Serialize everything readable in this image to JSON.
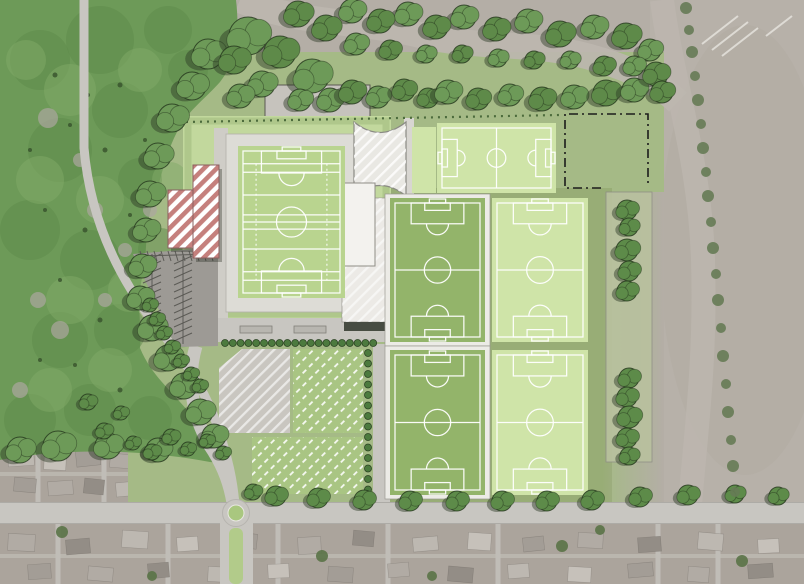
{
  "meta": {
    "description": "Aerial masterplan rendering of a sports grounds: a main hybrid stadium pitch with embankment, five training soccer pitches, a hatched entrance plaza, clubhouse pavilion, proposed red-hatched buildings, herringbone car park, allotment-style hatched plots, tree belts, woodland to the west, farmland to the east and housing along the southern road with a roundabout.",
    "visible_text": []
  },
  "palette": {
    "aerial": "#b4aea6",
    "farm": "#b7b1a9",
    "farmTrack": "#bdb7af",
    "road": "#c8c6c1",
    "parking": "#9d9a95",
    "woodland": "#6d9a58",
    "woodDark": "#5e8a49",
    "woodLight": "#81aa67",
    "treeGreen": "#5d8b49",
    "shadow": "#3c4a33",
    "siteGrass": "#a5ba86",
    "sage": "#8ea269",
    "platform": "#c2d89d",
    "embank": "#aac387",
    "frameFill": "#dddcd6",
    "stadiumPitch": "#b9d48f",
    "pitchLight": "#cfe4a8",
    "pitchDark": "#93b46a",
    "line": "#ffffff",
    "plotGreen": "#a9c583",
    "plotGrey": "#c9c6c0",
    "white": "#f3f2ee",
    "red": "#c5807d",
    "shrub": "#4c7a3e",
    "housingBase": "#aba49c",
    "median": "#b2cb8a",
    "roundGreen": "#a9c77f",
    "boundary": "#1c1c1c",
    "stripPanel": "#b9c19f",
    "farmTree": "#667b55",
    "houseShades": [
      "#bdb8b1",
      "#c6c1ba",
      "#a39d96",
      "#b1aba4",
      "#938d86"
    ]
  },
  "scene": {
    "pitches": [
      {
        "id": "stadium-pitch",
        "label": "Main stadium pitch (hybrid GAA/soccer markings)",
        "x": 238,
        "y": 146,
        "w": 107,
        "h": 152,
        "fill": "stadiumPitch",
        "orient": "v",
        "hybrid": true
      },
      {
        "id": "pitch-north",
        "label": "Training pitch north (horizontal)",
        "x": 437,
        "y": 123,
        "w": 119,
        "h": 70,
        "fill": "pitchLight",
        "orient": "h"
      },
      {
        "id": "pitch-mid-west",
        "label": "Training pitch centre-west",
        "x": 390,
        "y": 198,
        "w": 95,
        "h": 144,
        "fill": "pitchDark",
        "orient": "v",
        "frame": true
      },
      {
        "id": "pitch-mid-east",
        "label": "Training pitch centre-east",
        "x": 492,
        "y": 198,
        "w": 96,
        "h": 144,
        "fill": "pitchLight",
        "orient": "v"
      },
      {
        "id": "pitch-south-west",
        "label": "Training pitch south-west",
        "x": 390,
        "y": 350,
        "w": 95,
        "h": 145,
        "fill": "pitchDark",
        "orient": "v",
        "frame": true
      },
      {
        "id": "pitch-south-east",
        "label": "Training pitch south-east",
        "x": 492,
        "y": 350,
        "w": 96,
        "h": 145,
        "fill": "pitchLight",
        "orient": "v"
      }
    ],
    "trees": {
      "canopy": [
        [
          248,
          36,
          19
        ],
        [
          280,
          52,
          16
        ],
        [
          312,
          76,
          17
        ],
        [
          298,
          14,
          13
        ],
        [
          262,
          84,
          13
        ],
        [
          234,
          60,
          14
        ],
        [
          330,
          100,
          12
        ],
        [
          352,
          92,
          12
        ],
        [
          378,
          97,
          11
        ],
        [
          404,
          90,
          11
        ],
        [
          300,
          100,
          11
        ],
        [
          428,
          98,
          10
        ],
        [
          448,
          92,
          12
        ],
        [
          478,
          99,
          11
        ],
        [
          510,
          95,
          11
        ],
        [
          542,
          99,
          12
        ],
        [
          574,
          97,
          12
        ],
        [
          606,
          93,
          13
        ],
        [
          634,
          90,
          12
        ],
        [
          656,
          74,
          12
        ],
        [
          650,
          50,
          11
        ],
        [
          626,
          36,
          13
        ],
        [
          594,
          27,
          12
        ],
        [
          560,
          34,
          13
        ],
        [
          528,
          21,
          12
        ],
        [
          496,
          29,
          12
        ],
        [
          464,
          17,
          12
        ],
        [
          436,
          27,
          12
        ],
        [
          408,
          14,
          12
        ],
        [
          380,
          21,
          12
        ],
        [
          352,
          11,
          12
        ],
        [
          326,
          28,
          13
        ],
        [
          356,
          44,
          11
        ],
        [
          390,
          50,
          10
        ],
        [
          426,
          54,
          9
        ],
        [
          462,
          54,
          9
        ],
        [
          498,
          58,
          9
        ],
        [
          534,
          60,
          9
        ],
        [
          570,
          60,
          9
        ],
        [
          604,
          66,
          10
        ],
        [
          634,
          66,
          10
        ],
        [
          662,
          92,
          11
        ],
        [
          240,
          96,
          12
        ]
      ],
      "edge": [
        [
          208,
          54,
          15
        ],
        [
          192,
          86,
          14
        ],
        [
          172,
          118,
          14
        ],
        [
          158,
          156,
          13
        ],
        [
          150,
          194,
          13
        ],
        [
          146,
          230,
          12
        ],
        [
          142,
          266,
          12
        ],
        [
          140,
          298,
          12
        ],
        [
          152,
          328,
          13
        ],
        [
          168,
          358,
          13
        ],
        [
          184,
          386,
          13
        ],
        [
          200,
          412,
          13
        ],
        [
          214,
          436,
          12
        ],
        [
          58,
          446,
          15
        ],
        [
          108,
          446,
          13
        ],
        [
          158,
          450,
          12
        ],
        [
          20,
          450,
          13
        ]
      ],
      "scatter": [
        [
          88,
          402,
          8
        ],
        [
          104,
          431,
          8
        ],
        [
          121,
          413,
          7
        ],
        [
          133,
          443,
          7
        ],
        [
          152,
          452,
          8
        ],
        [
          171,
          437,
          8
        ],
        [
          188,
          449,
          7
        ],
        [
          207,
          441,
          7
        ],
        [
          223,
          453,
          7
        ],
        [
          150,
          305,
          7
        ],
        [
          157,
          319,
          7
        ],
        [
          164,
          333,
          7
        ],
        [
          172,
          347,
          7
        ],
        [
          181,
          361,
          7
        ],
        [
          191,
          374,
          7
        ],
        [
          200,
          386,
          7
        ],
        [
          253,
          492,
          8
        ],
        [
          276,
          496,
          10
        ]
      ],
      "strip": [
        [
          627,
          210,
          10
        ],
        [
          629,
          227,
          9
        ],
        [
          627,
          250,
          11
        ],
        [
          629,
          271,
          10
        ],
        [
          627,
          291,
          10
        ],
        [
          629,
          378,
          10
        ],
        [
          627,
          397,
          10
        ],
        [
          629,
          417,
          11
        ],
        [
          627,
          438,
          10
        ],
        [
          629,
          456,
          9
        ]
      ],
      "road": [
        [
          318,
          498,
          10
        ],
        [
          364,
          500,
          10
        ],
        [
          410,
          501,
          10
        ],
        [
          457,
          501,
          10
        ],
        [
          502,
          501,
          10
        ],
        [
          547,
          501,
          10
        ],
        [
          592,
          500,
          10
        ],
        [
          640,
          497,
          10
        ],
        [
          688,
          495,
          10
        ],
        [
          735,
          494,
          9
        ],
        [
          778,
          496,
          9
        ]
      ],
      "farmline": [
        [
          686,
          8,
          6
        ],
        [
          689,
          30,
          5
        ],
        [
          692,
          52,
          6
        ],
        [
          695,
          76,
          5
        ],
        [
          698,
          100,
          6
        ],
        [
          701,
          124,
          5
        ],
        [
          703,
          148,
          6
        ],
        [
          706,
          172,
          5
        ],
        [
          708,
          196,
          6
        ],
        [
          711,
          222,
          5
        ],
        [
          713,
          248,
          6
        ],
        [
          716,
          274,
          5
        ],
        [
          718,
          300,
          6
        ],
        [
          721,
          328,
          5
        ],
        [
          723,
          356,
          6
        ],
        [
          726,
          384,
          5
        ],
        [
          728,
          412,
          6
        ],
        [
          731,
          440,
          5
        ],
        [
          733,
          466,
          6
        ],
        [
          735,
          492,
          5
        ]
      ],
      "housing": [
        [
          62,
          532,
          6
        ],
        [
          322,
          556,
          6
        ],
        [
          562,
          546,
          6
        ],
        [
          742,
          561,
          6
        ],
        [
          152,
          576,
          5
        ],
        [
          432,
          576,
          5
        ],
        [
          600,
          530,
          5
        ]
      ]
    },
    "woodtex": {
      "dark": [
        [
          40,
          60,
          30
        ],
        [
          100,
          40,
          34
        ],
        [
          168,
          30,
          24
        ],
        [
          60,
          150,
          32
        ],
        [
          120,
          110,
          28
        ],
        [
          30,
          230,
          30
        ],
        [
          90,
          260,
          30
        ],
        [
          60,
          340,
          28
        ],
        [
          120,
          330,
          26
        ],
        [
          30,
          420,
          26
        ],
        [
          90,
          410,
          26
        ],
        [
          160,
          250,
          22
        ],
        [
          140,
          180,
          22
        ],
        [
          188,
          70,
          20
        ],
        [
          150,
          418,
          22
        ]
      ],
      "light": [
        [
          70,
          90,
          26
        ],
        [
          140,
          70,
          22
        ],
        [
          40,
          180,
          24
        ],
        [
          100,
          200,
          24
        ],
        [
          70,
          300,
          24
        ],
        [
          130,
          290,
          22
        ],
        [
          50,
          390,
          22
        ],
        [
          110,
          370,
          22
        ],
        [
          170,
          180,
          18
        ],
        [
          180,
          330,
          18
        ],
        [
          26,
          60,
          20
        ]
      ],
      "gaps": [
        [
          48,
          118,
          10
        ],
        [
          95,
          210,
          8
        ],
        [
          60,
          330,
          9
        ],
        [
          105,
          300,
          7
        ],
        [
          150,
          210,
          7
        ],
        [
          38,
          300,
          8
        ],
        [
          80,
          160,
          7
        ],
        [
          125,
          250,
          7
        ],
        [
          20,
          390,
          8
        ]
      ],
      "spots": [
        [
          55,
          75,
          2.5
        ],
        [
          88,
          95,
          2
        ],
        [
          120,
          85,
          2.5
        ],
        [
          70,
          125,
          2
        ],
        [
          105,
          150,
          2.5
        ],
        [
          45,
          210,
          2
        ],
        [
          85,
          230,
          2.5
        ],
        [
          130,
          215,
          2
        ],
        [
          60,
          280,
          2
        ],
        [
          100,
          320,
          2.5
        ],
        [
          40,
          360,
          2
        ],
        [
          120,
          390,
          2.5
        ],
        [
          155,
          300,
          2
        ],
        [
          145,
          140,
          2
        ],
        [
          30,
          150,
          2
        ],
        [
          75,
          365,
          2
        ]
      ]
    },
    "houses": [
      [
        8,
        450,
        26,
        16,
        -4
      ],
      [
        44,
        456,
        22,
        14,
        3
      ],
      [
        76,
        449,
        24,
        17,
        -6
      ],
      [
        110,
        454,
        21,
        14,
        5
      ],
      [
        139,
        459,
        25,
        15,
        -3
      ],
      [
        173,
        451,
        22,
        17,
        4
      ],
      [
        199,
        457,
        18,
        12,
        -5
      ],
      [
        14,
        478,
        22,
        14,
        5
      ],
      [
        48,
        481,
        25,
        14,
        -4
      ],
      [
        84,
        479,
        20,
        15,
        6
      ],
      [
        116,
        482,
        23,
        14,
        -5
      ],
      [
        149,
        480,
        20,
        14,
        4
      ],
      [
        183,
        479,
        23,
        15,
        -3
      ],
      [
        8,
        534,
        27,
        17,
        3
      ],
      [
        66,
        539,
        24,
        15,
        -5
      ],
      [
        122,
        531,
        26,
        17,
        4
      ],
      [
        177,
        537,
        21,
        14,
        -4
      ],
      [
        232,
        533,
        25,
        15,
        6
      ],
      [
        298,
        537,
        23,
        17,
        -3
      ],
      [
        353,
        531,
        21,
        15,
        5
      ],
      [
        413,
        537,
        25,
        14,
        -5
      ],
      [
        468,
        533,
        23,
        17,
        4
      ],
      [
        523,
        537,
        21,
        14,
        -6
      ],
      [
        578,
        533,
        25,
        15,
        3
      ],
      [
        638,
        537,
        23,
        15,
        -4
      ],
      [
        698,
        533,
        25,
        17,
        5
      ],
      [
        758,
        539,
        21,
        14,
        -3
      ],
      [
        28,
        564,
        23,
        15,
        -4
      ],
      [
        88,
        567,
        25,
        14,
        5
      ],
      [
        148,
        563,
        21,
        15,
        -5
      ],
      [
        208,
        567,
        25,
        15,
        3
      ],
      [
        268,
        564,
        21,
        14,
        -3
      ],
      [
        328,
        567,
        25,
        15,
        4
      ],
      [
        388,
        563,
        21,
        14,
        -5
      ],
      [
        448,
        567,
        25,
        15,
        5
      ],
      [
        508,
        564,
        21,
        14,
        -4
      ],
      [
        568,
        567,
        23,
        15,
        3
      ],
      [
        628,
        563,
        25,
        14,
        -5
      ],
      [
        688,
        567,
        21,
        15,
        4
      ],
      [
        748,
        564,
        25,
        14,
        -4
      ]
    ],
    "parkingRows": [
      {
        "dir": "v",
        "x": 152,
        "y0": 258,
        "y1": 336,
        "step": 7,
        "len": 9
      },
      {
        "dir": "v",
        "x": 183,
        "y0": 260,
        "y1": 340,
        "step": 7,
        "len": 9
      },
      {
        "dir": "h",
        "y": 256,
        "x0": 140,
        "x1": 214,
        "step": 7,
        "len": 9
      }
    ],
    "shrubRows": {
      "horizontal": {
        "y": 343,
        "x0": 225,
        "step": 7.8,
        "count": 20,
        "r": 3.5
      },
      "vertical": {
        "x": 368,
        "y0": 353,
        "step": 10.5,
        "count": 14,
        "r": 3.5
      }
    }
  }
}
